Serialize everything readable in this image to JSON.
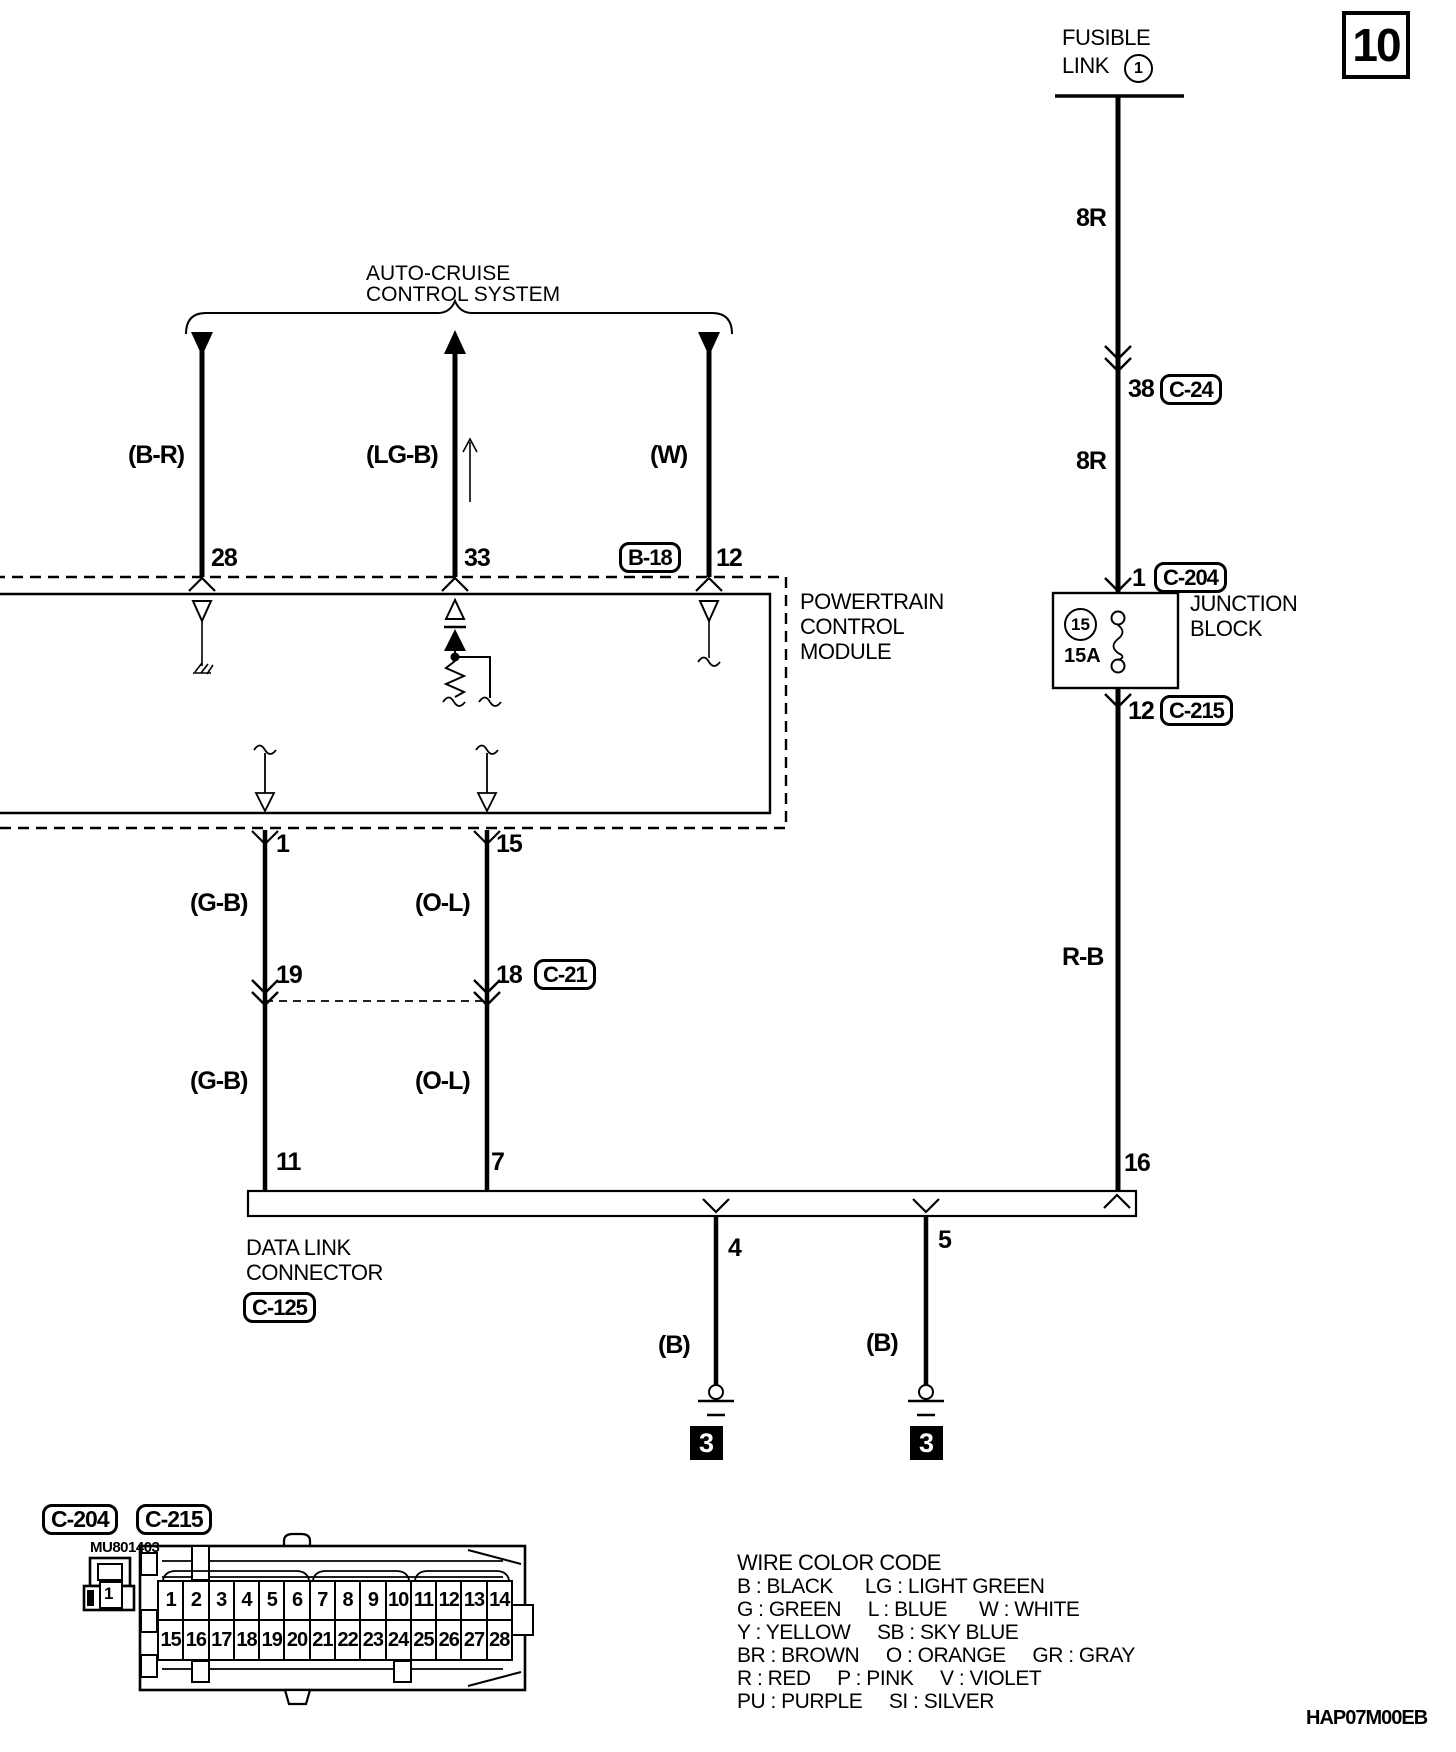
{
  "page": {
    "number": "10",
    "figure_code": "HAP07M00EB"
  },
  "power_feed": {
    "source_line1": "FUSIBLE",
    "source_line2": "LINK",
    "source_number": "1",
    "wire_upper": "8R",
    "splice_pin": "38",
    "splice_connector": "C-24",
    "wire_lower": "8R",
    "jb_entry_pin": "1",
    "jb_entry_connector": "C-204",
    "jb_exit_pin": "12",
    "jb_exit_connector": "C-215",
    "wire_to_dlc": "R-B",
    "dlc_pin": "16"
  },
  "junction_block": {
    "line1": "JUNCTION",
    "line2": "BLOCK",
    "fuse_number": "15",
    "fuse_rating": "15A"
  },
  "auto_cruise": {
    "title_line1": "AUTO-CRUISE",
    "title_line2": "CONTROL SYSTEM",
    "wire_a_color": "(B-R)",
    "wire_a_pin": "28",
    "wire_b_color": "(LG-B)",
    "wire_b_pin": "33",
    "wire_c_color": "(W)",
    "wire_c_pin": "12",
    "wire_c_connector": "B-18"
  },
  "pcm": {
    "line1": "POWERTRAIN",
    "line2": "CONTROL",
    "line3": "MODULE",
    "pin_left": "1",
    "pin_right": "15"
  },
  "diagnosis_lines": {
    "left_wire_upper": "(G-B)",
    "right_wire_upper": "(O-L)",
    "left_splice_pin": "19",
    "right_splice_pin": "18",
    "splice_connector": "C-21",
    "left_wire_lower": "(G-B)",
    "right_wire_lower": "(O-L)",
    "left_dlc_pin": "11",
    "right_dlc_pin": "7"
  },
  "dlc": {
    "line1": "DATA LINK",
    "line2": "CONNECTOR",
    "connector": "C-125",
    "ground_pin_left": "4",
    "ground_pin_right": "5",
    "ground_wire_left": "(B)",
    "ground_wire_right": "(B)",
    "ground_ref_left": "3",
    "ground_ref_right": "3"
  },
  "connector_views": {
    "label_left": "C-204",
    "label_right": "C-215",
    "part_number": "MU801403",
    "small_connector_pin": "1",
    "row1": [
      "1",
      "2",
      "3",
      "4",
      "5",
      "6",
      "7",
      "8",
      "9",
      "10",
      "11",
      "12",
      "13",
      "14"
    ],
    "row2": [
      "15",
      "16",
      "17",
      "18",
      "19",
      "20",
      "21",
      "22",
      "23",
      "24",
      "25",
      "26",
      "27",
      "28"
    ]
  },
  "wire_color_code": {
    "title": "WIRE COLOR CODE",
    "lines": [
      "B : BLACK      LG : LIGHT GREEN",
      "G : GREEN     L : BLUE      W : WHITE",
      "Y : YELLOW     SB : SKY BLUE",
      "BR : BROWN     O : ORANGE     GR : GRAY",
      "R : RED     P : PINK     V : VIOLET",
      "PU : PURPLE     SI : SILVER"
    ]
  },
  "colors": {
    "ink": "#000000",
    "paper": "#ffffff"
  }
}
